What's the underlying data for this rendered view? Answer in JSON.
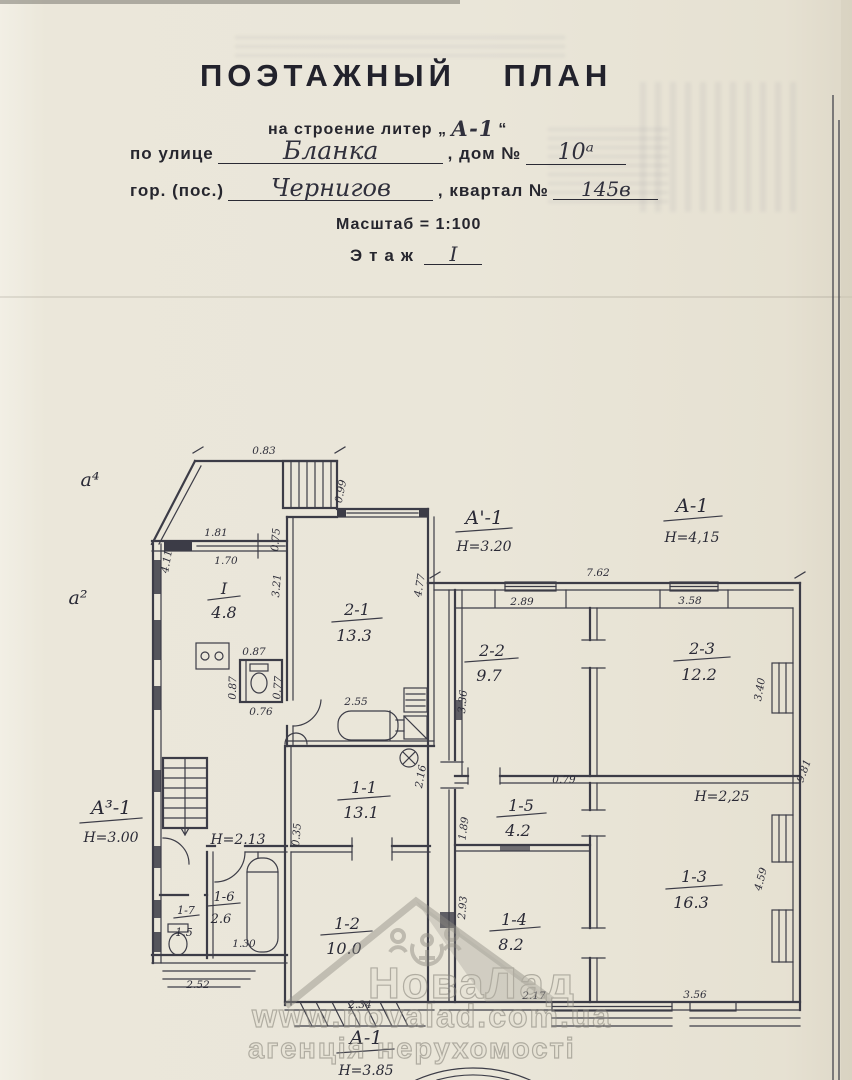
{
  "header": {
    "title": "ПОЭТАЖНЫЙ ПЛАН",
    "subtitle_prefix": "на строение литер „",
    "subtitle_litera": "А-1",
    "subtitle_suffix": "“",
    "street_label": "по улице",
    "street_value": "Бланка",
    "house_label": ", дом №",
    "house_value": "10ᵃ",
    "city_label": "гор. (пос.)",
    "city_value": "Чернигов",
    "block_label": ", квартал №",
    "block_value": "145в",
    "scale_line": "Масштаб = 1:100",
    "floor_label": "Этаж",
    "floor_value": "I"
  },
  "plan": {
    "building_labels": [
      {
        "litera": "а⁴"
      },
      {
        "litera": "а²"
      },
      {
        "litera": "А'-1",
        "height": "Н=3.20"
      },
      {
        "litera": "А-1",
        "height": "Н=4,15"
      },
      {
        "litera": "А³-1",
        "height": "Н=3.00"
      },
      {
        "litera": "А-1",
        "height": "Н=3.85"
      }
    ],
    "height_labels": [
      "Н=2.13",
      "Н=2,25"
    ],
    "rooms": [
      {
        "number": "I",
        "area": "4.8"
      },
      {
        "number": "2-1",
        "area": "13.3"
      },
      {
        "number": "2-2",
        "area": "9.7"
      },
      {
        "number": "2-3",
        "area": "12.2"
      },
      {
        "number": "1-1",
        "area": "13.1"
      },
      {
        "number": "1-2",
        "area": "10.0"
      },
      {
        "number": "1-3",
        "area": "16.3"
      },
      {
        "number": "1-4",
        "area": "8.2"
      },
      {
        "number": "1-5",
        "area": "4.2"
      },
      {
        "number": "1-6",
        "area": "2.6"
      },
      {
        "number": "1-7",
        "area": "1.5"
      }
    ],
    "dims": [
      "0.83",
      "0.99",
      "1.81",
      "1.70",
      "4.11",
      "0.75",
      "3.21",
      "4.77",
      "7.62",
      "2.89",
      "3.58",
      "3.36",
      "3.40",
      "2.55",
      "0.87",
      "0.87",
      "0.76",
      "0.77",
      "2.16",
      "0.35",
      "0.79",
      "1.89",
      "9.81",
      "4.59",
      "2.93",
      "2.17",
      "3.56",
      "1.30",
      "2.52",
      "2.34"
    ]
  },
  "watermark": {
    "brand": "НоваЛад",
    "url": "www.novalad.com.ua",
    "tagline": "агенція нерухомості"
  }
}
